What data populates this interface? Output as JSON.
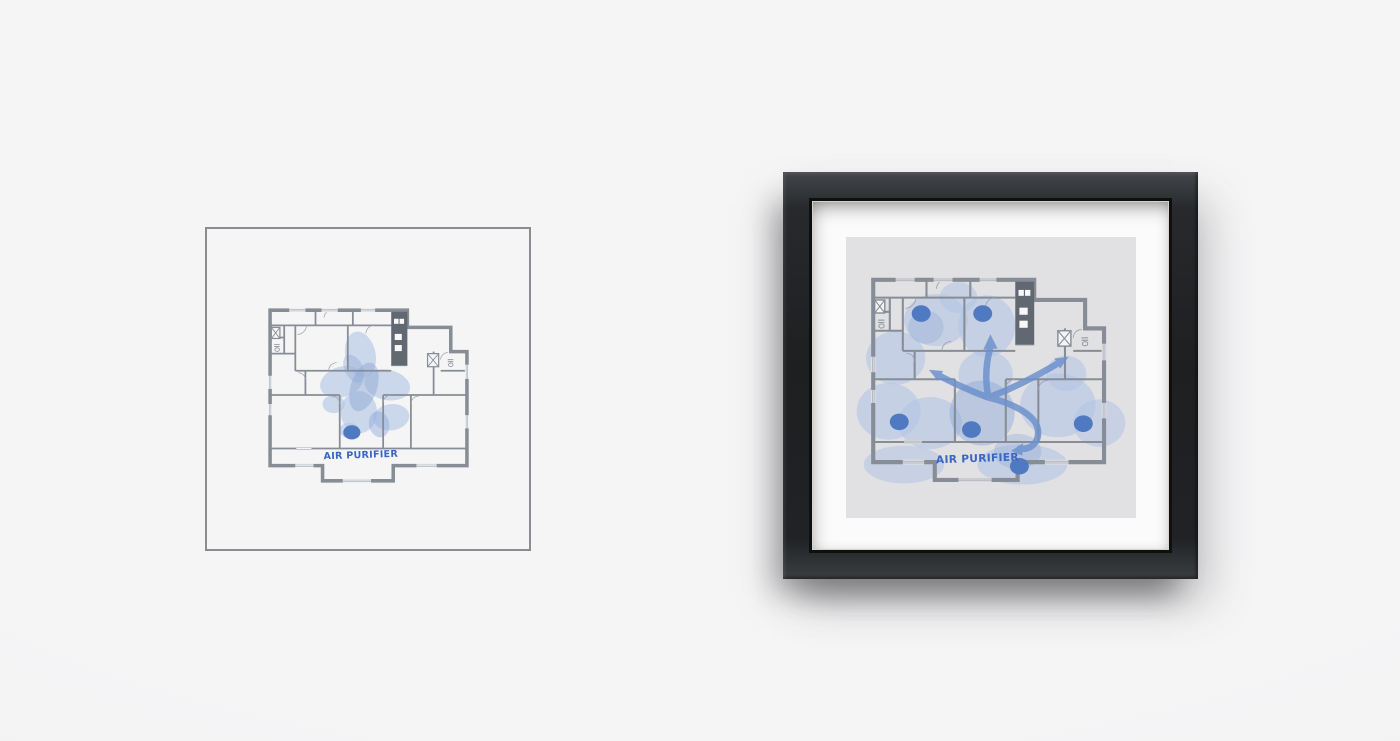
{
  "scene": {
    "description": "two floor-plan art prints on a light wall",
    "wall_color": "#f3f3f4"
  },
  "left_print": {
    "label": "AIR PURIFIER",
    "border_color": "#8a8c8f",
    "background": "#f5f5f6",
    "purifier_dot_count": 1
  },
  "right_print": {
    "label": "AIR PURIFIER",
    "frame_color": "#232528",
    "mat_color": "#fbfbfc",
    "art_background": "#e1e1e3",
    "purifier_dot_count": 6,
    "airflow_arrow_count": 4
  },
  "palette": {
    "wall_lines": "#878d96",
    "stair_core": "#626872",
    "coverage_blob": "#b2c5e4",
    "coverage_blob_dark": "#8fa9d6",
    "purifier_dot": "#4f7ac1",
    "airflow_arrow": "#6e92cd",
    "label_text": "#3767c2"
  }
}
